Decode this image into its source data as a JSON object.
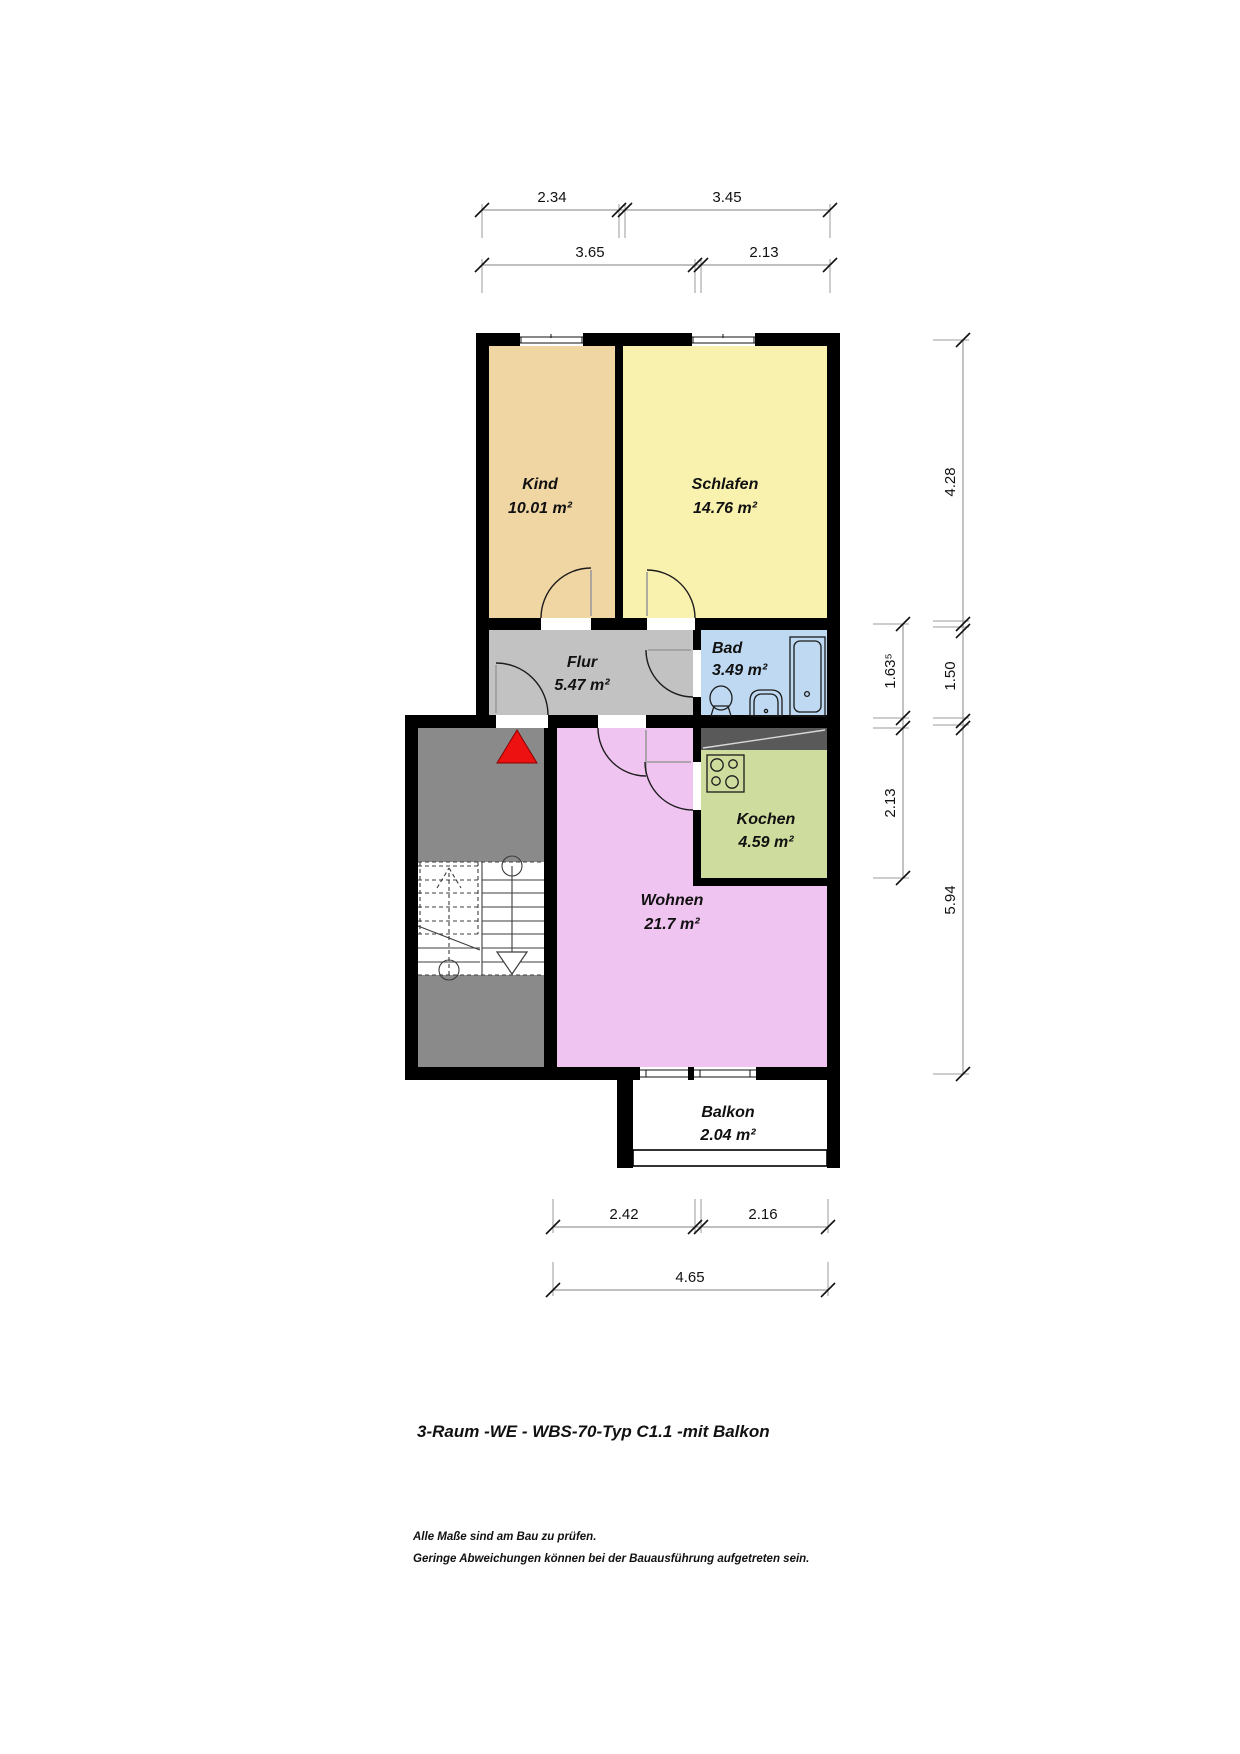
{
  "plan": {
    "title": "3-Raum -WE - WBS-70-Typ C1.1 -mit Balkon",
    "notes": {
      "line1": "Alle Maße sind am Bau zu prüfen.",
      "line2": "Geringe Abweichungen können bei der Bauausführung aufgetreten sein."
    },
    "rooms": {
      "kind": {
        "name": "Kind",
        "area": "10.01 m²",
        "color": "#f0d6a2"
      },
      "schlafen": {
        "name": "Schlafen",
        "area": "14.76 m²",
        "color": "#f9f2af"
      },
      "flur": {
        "name": "Flur",
        "area": "5.47 m²",
        "color": "#c2c2c2"
      },
      "bad": {
        "name": "Bad",
        "area": "3.49 m²",
        "color": "#bed9f1"
      },
      "kochen": {
        "name": "Kochen",
        "area": "4.59 m²",
        "color": "#cedc9e"
      },
      "wohnen": {
        "name": "Wohnen",
        "area": "21.7 m²",
        "color": "#f0c4f0"
      },
      "balkon": {
        "name": "Balkon",
        "area": "2.04 m²",
        "color": "#ffffff"
      }
    },
    "dimensions": {
      "top": {
        "row1": [
          "2.34",
          "3.45"
        ],
        "row2": [
          "3.65",
          "2.13"
        ]
      },
      "right": {
        "inner": [
          "1.63⁵",
          "2.13"
        ],
        "outer": [
          "4.28",
          "1.50",
          "5.94"
        ]
      },
      "bottom": {
        "row1": [
          "2.42",
          "2.16"
        ],
        "row2": [
          "4.65"
        ]
      }
    },
    "colors": {
      "wall": "#000000",
      "stair_landing": "#8a8a8a",
      "shaft": "#595959",
      "entrance_arrow": "#ee1111"
    }
  }
}
